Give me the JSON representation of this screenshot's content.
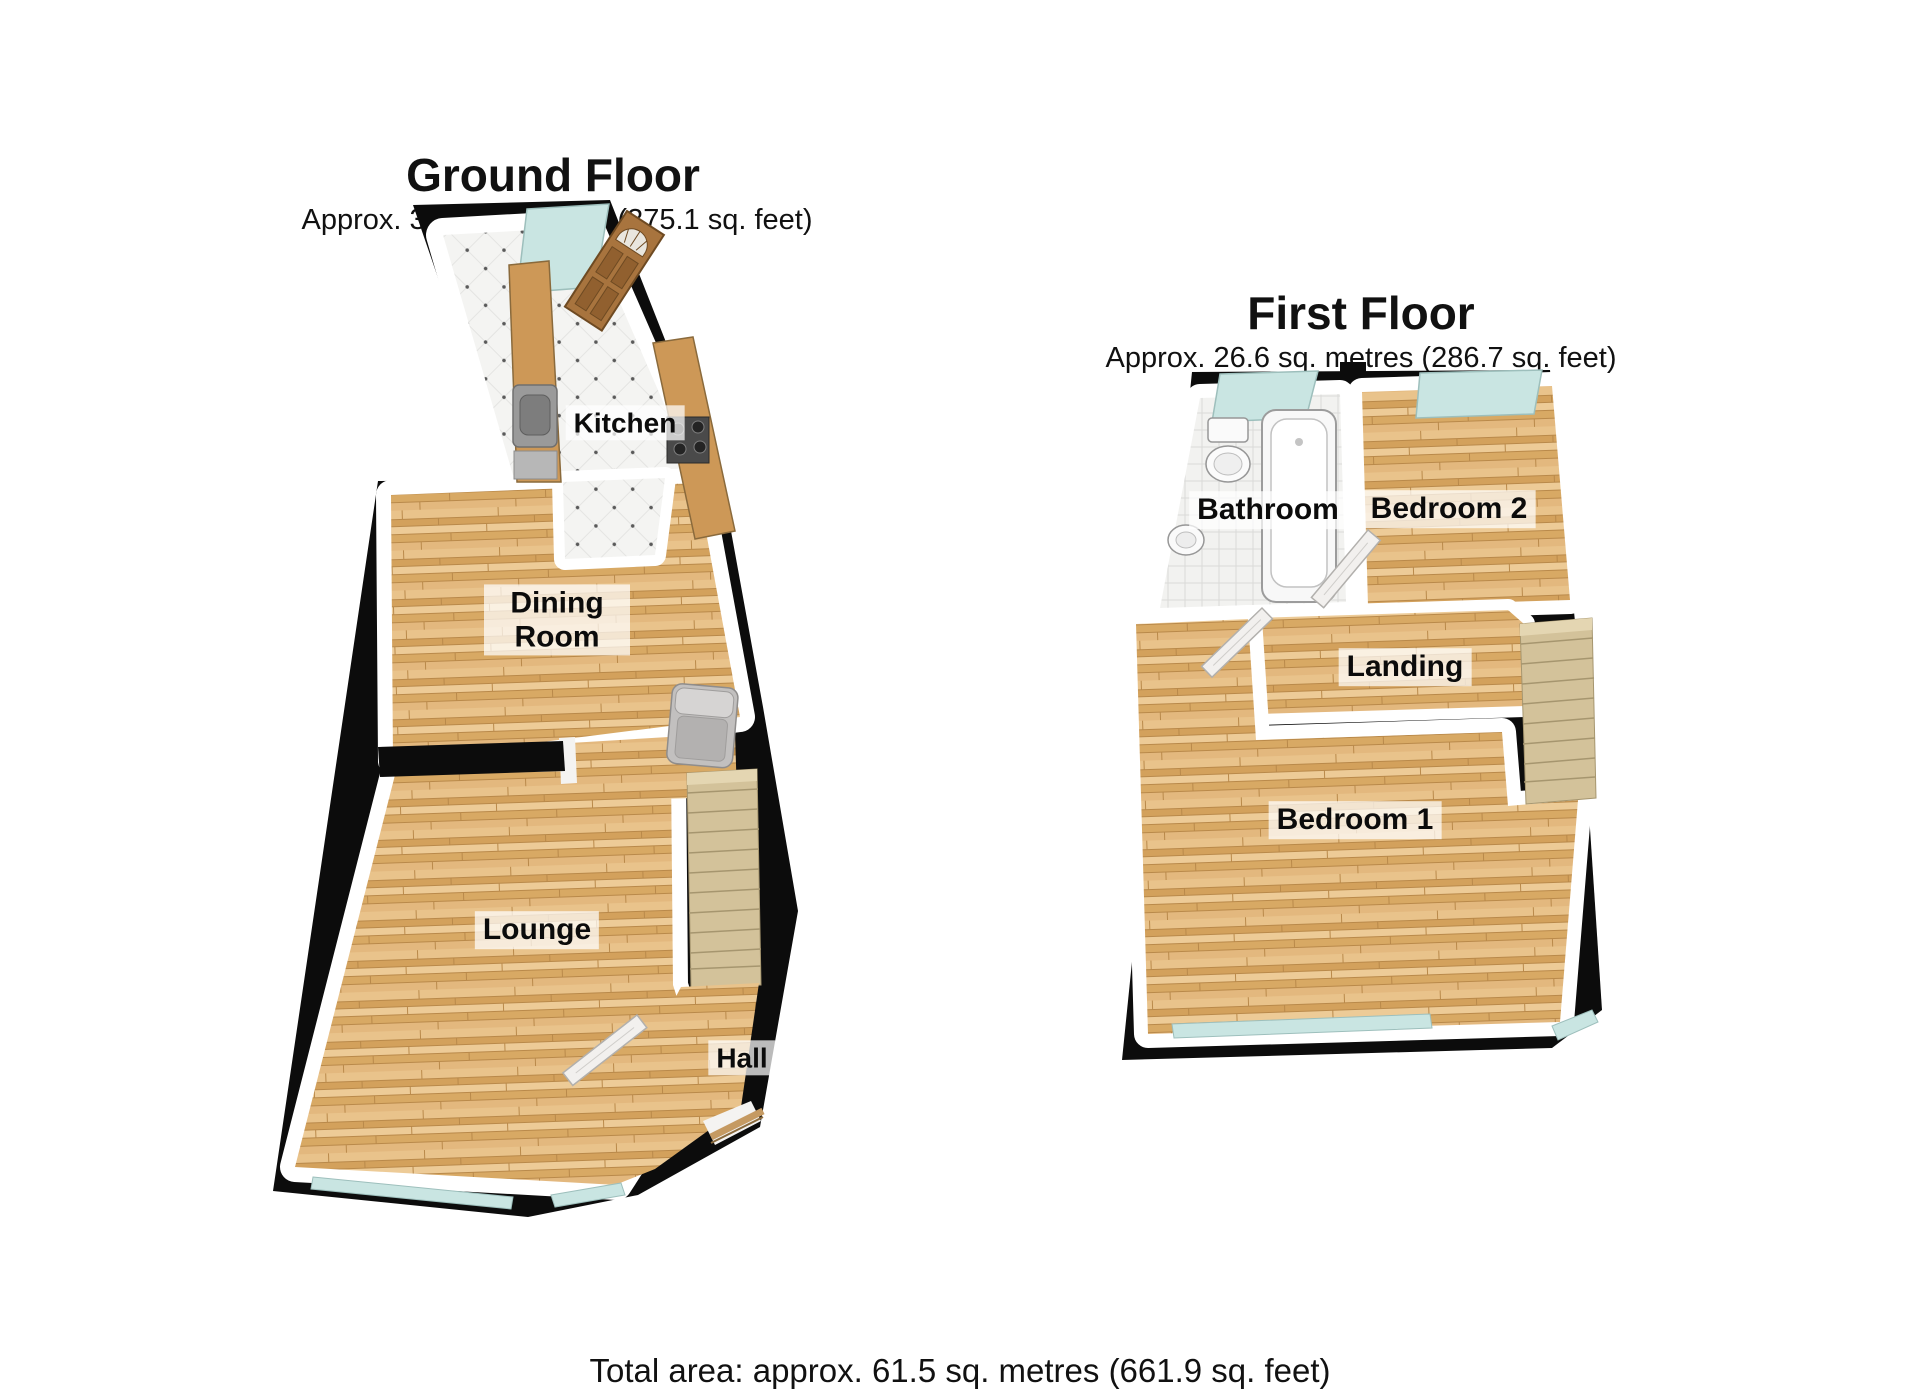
{
  "ground_floor": {
    "title": "Ground Floor",
    "area": "Approx. 34.9 sq. metres (375.1 sq. feet)",
    "rooms": {
      "kitchen": "Kitchen",
      "dining_room": "Dining Room",
      "lounge": "Lounge",
      "hall": "Hall"
    }
  },
  "first_floor": {
    "title": "First Floor",
    "area": "Approx. 26.6 sq. metres (286.7 sq. feet)",
    "rooms": {
      "bathroom": "Bathroom",
      "bedroom2": "Bedroom 2",
      "landing": "Landing",
      "bedroom1": "Bedroom 1"
    }
  },
  "footer": {
    "total_area": "Total area: approx. 61.5 sq. metres (661.9 sq. feet)"
  },
  "colors": {
    "wall": "#0c0c0c",
    "wood_floor": "#dfb274",
    "tile_floor": "#f4f4f2",
    "window_glass": "#c9e5e2",
    "stairs": "#d3c29a",
    "door_wood": "#a8743e"
  }
}
